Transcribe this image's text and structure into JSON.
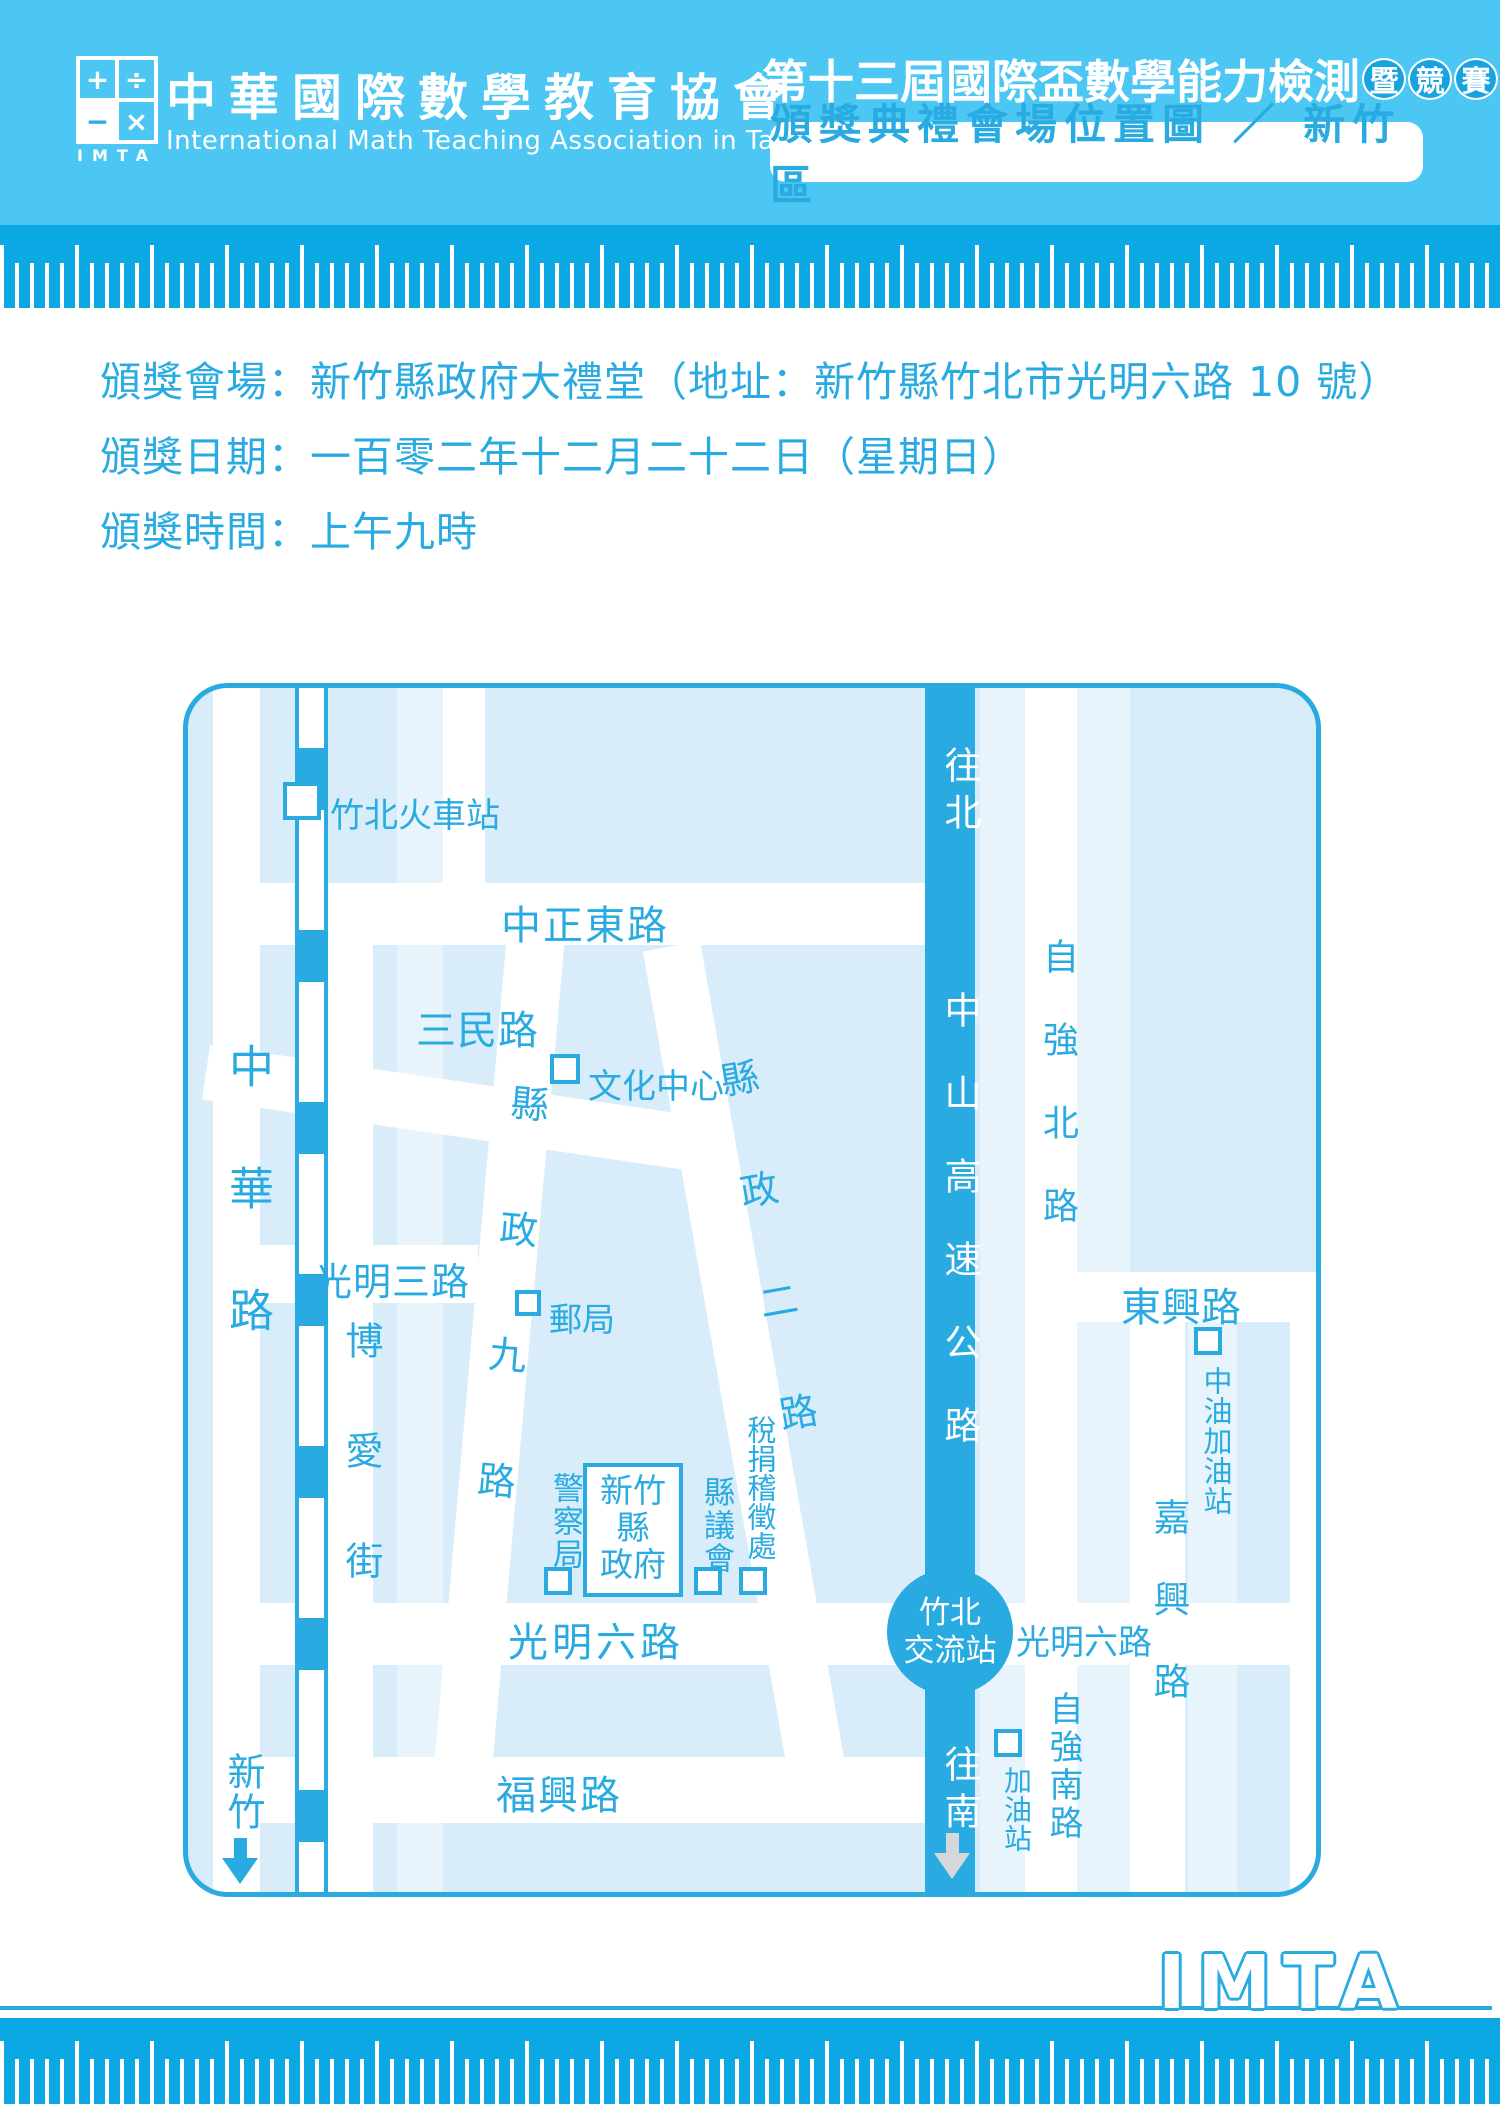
{
  "header": {
    "logo": {
      "symbols": [
        "+",
        "÷",
        "−",
        "×"
      ],
      "acronym": "IMTA"
    },
    "org_name_zh": "中華國際數學教育協會",
    "org_name_en": "International Math Teaching Association in Taiwan",
    "title": "第十三屆國際盃數學能力檢測",
    "badges": [
      "暨",
      "競",
      "賽"
    ],
    "subtitle": "頒獎典禮會場位置圖 ／ 新竹區"
  },
  "info": {
    "venue": "頒獎會場：新竹縣政府大禮堂（地址：新竹縣竹北市光明六路 10 號）",
    "date": "頒獎日期：一百零二年十二月二十二日（星期日）",
    "time": "頒獎時間：上午九時"
  },
  "map": {
    "train_station": "竹北火車站",
    "roads": {
      "zhonghua": "中華路",
      "zhongzheng_east": "中正東路",
      "sanmin": "三民路",
      "guangming_3": "光明三路",
      "boai": "博愛街",
      "xianzheng_9": "縣政九路",
      "xianzheng_2": "縣政二路",
      "guangming_6_left": "光明六路",
      "guangming_6_right": "光明六路",
      "fuxing": "福興路",
      "dongxing": "東興路",
      "ziqiang_north": "自強北路",
      "ziqiang_south": "自強南路",
      "jiaxing": "嘉興路"
    },
    "highway": {
      "to_north": "往北",
      "name": "中山高速公路",
      "interchange": "竹北\n交流站",
      "to_south": "往南"
    },
    "landmarks": {
      "culture_center": "文化中心",
      "post_office": "郵局",
      "police": "警察局",
      "county_gov": "新竹縣\n政府",
      "county_council": "縣議會",
      "tax_office": "稅捐稽徵處",
      "cpc_gas_station": "中油加油站",
      "gas_station": "加油站",
      "to_hsinchu": "新竹"
    }
  },
  "footer": {
    "logo": "IMTA"
  },
  "colors": {
    "header_bg": "#4CC7F3",
    "ruler_bg": "#0CA8E4",
    "accent_blue": "#29ABE2",
    "map_bg": "#D8EDF9",
    "map_light_block": "#E8F4FC",
    "road_white": "#FFFFFF",
    "south_arrow_gray": "#D6D7D9"
  }
}
